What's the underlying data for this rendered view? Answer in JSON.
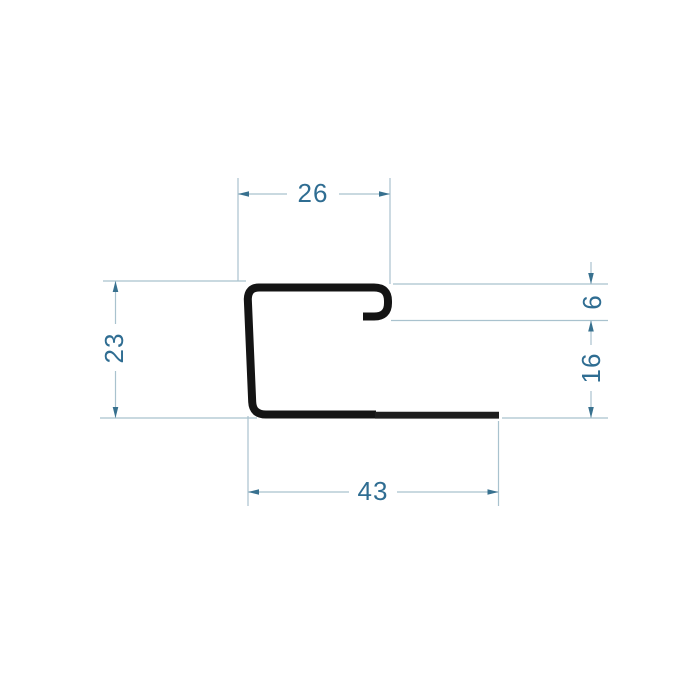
{
  "drawing": {
    "labels": {
      "top_width": "26",
      "left_height": "23",
      "hook_opening": "6",
      "right_lower_height": "16",
      "bottom_width": "43"
    }
  },
  "colors": {
    "background": "#ffffff",
    "profile": "#141414",
    "dim_line": "#a9c2ce",
    "dim_arrow": "#38718f",
    "dim_text": "#2f6d92"
  }
}
